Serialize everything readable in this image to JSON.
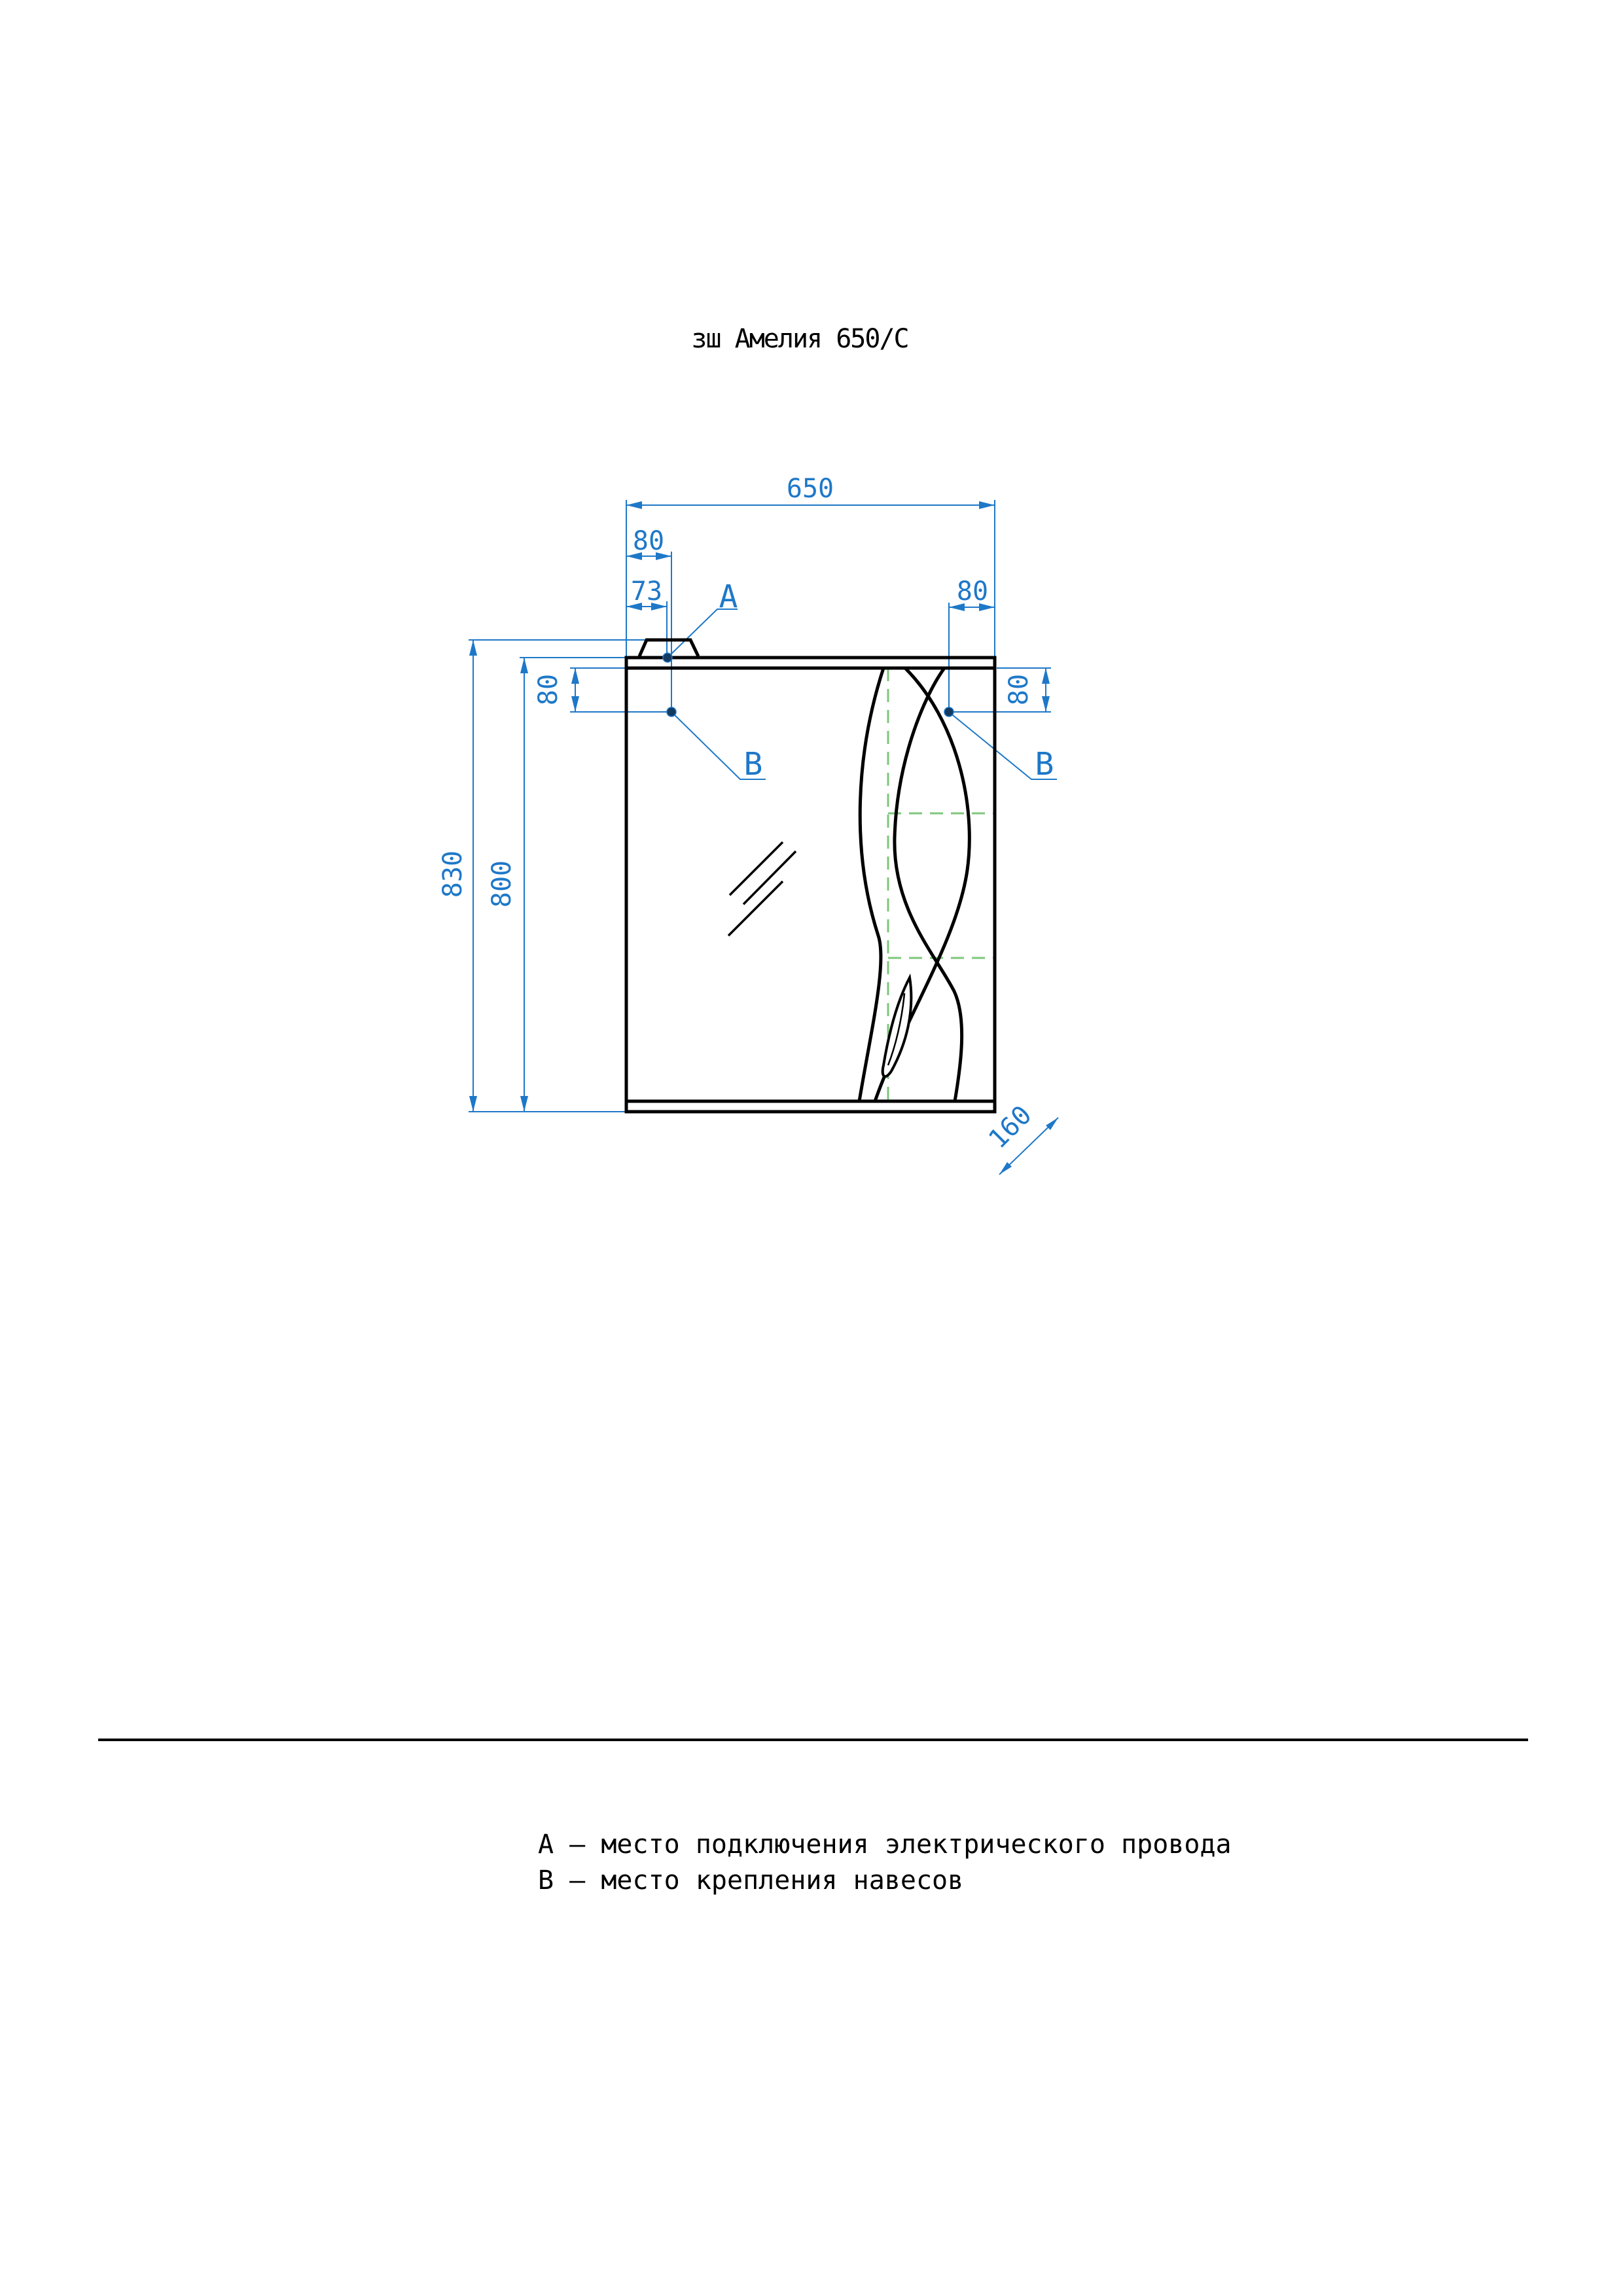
{
  "colors": {
    "dimension": "#1e78c8",
    "hidden_line": "#7dc77a",
    "marker_dot": "#133a61",
    "drawing": "#000000",
    "background": "#ffffff"
  },
  "drawing": {
    "product_title": "зш Амелия 650/С",
    "dimensions": {
      "overall_width": "650",
      "hinge_offset_left": "80",
      "power_offset_left": "73",
      "hinge_offset_right": "80",
      "overall_height": "830",
      "body_height": "800",
      "hinge_drop_left": "80",
      "hinge_drop_right": "80",
      "depth": "160"
    },
    "markers": {
      "a": "А",
      "b_left": "В",
      "b_right": "В"
    }
  },
  "legend": {
    "items": [
      {
        "text": "А – место подключения электрического провода"
      },
      {
        "text": "В – место крепления навесов"
      }
    ]
  }
}
